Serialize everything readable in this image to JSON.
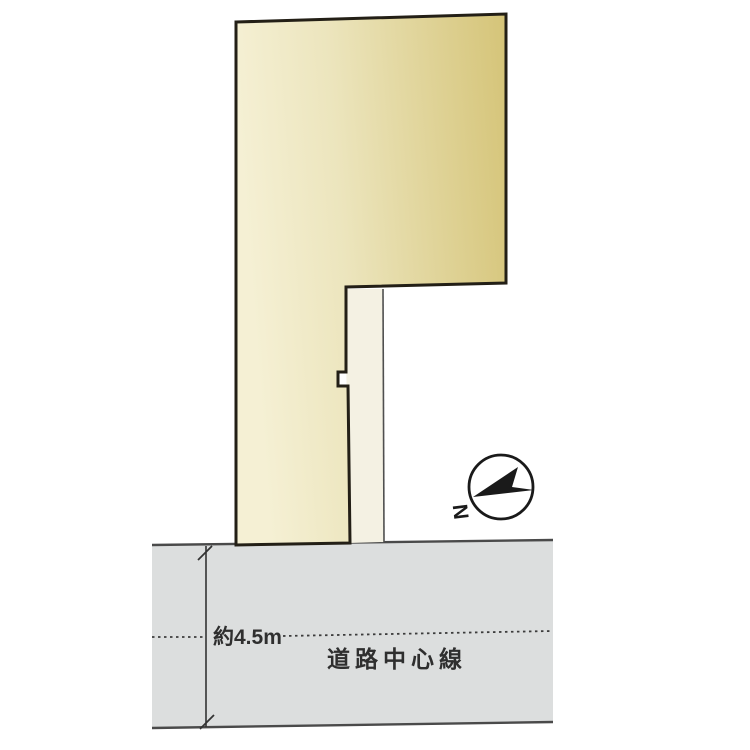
{
  "diagram": {
    "type": "real-estate-site-plan",
    "labels": {
      "road_width": "約4.5m",
      "road_center_line": "道路中心線",
      "north": "N"
    },
    "colors": {
      "plot_fill_light": "#f5f0d4",
      "plot_fill_dark": "#d5c478",
      "plot_border": "#231f16",
      "strip_fill": "#f4f1e3",
      "strip_border": "#4f4f4f",
      "road_fill": "#dcdede",
      "road_border": "#4a4a4a",
      "dashed_line": "#3c3c3c",
      "dimension_line": "#333333",
      "text": "#2f2f2f",
      "compass_ink": "#1a1a1a",
      "background": "#ffffff"
    }
  }
}
